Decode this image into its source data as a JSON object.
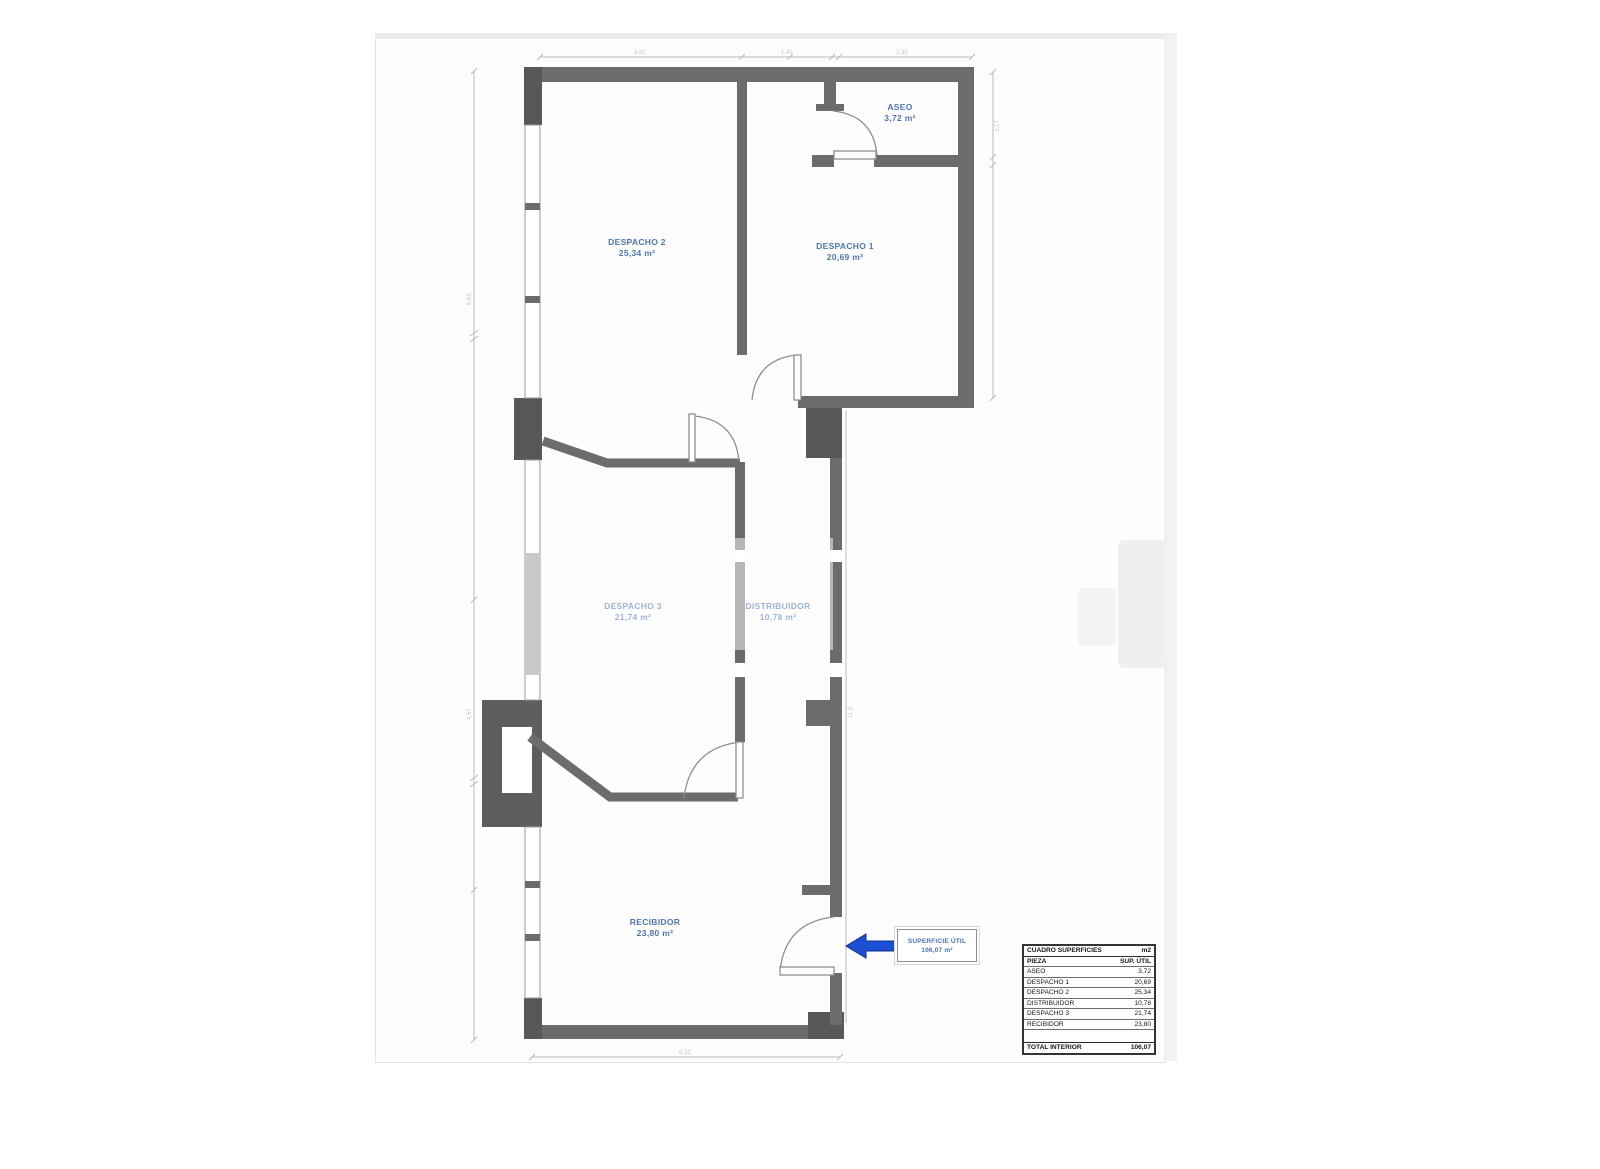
{
  "plan": {
    "rooms": [
      {
        "name": "ASEO",
        "area": "3,72 m²"
      },
      {
        "name": "DESPACHO 2",
        "area": "25,34 m²"
      },
      {
        "name": "DESPACHO 1",
        "area": "20,69 m²"
      },
      {
        "name": "DESPACHO 3",
        "area": "21,74 m²"
      },
      {
        "name": "DISTRIBUIDOR",
        "area": "10,78 m²"
      },
      {
        "name": "RECIBIDOR",
        "area": "23,80 m²"
      }
    ],
    "callout": {
      "title": "SUPERFICIE ÚTIL",
      "value": "106,07 m²"
    },
    "dimensions": {
      "top": [
        "3,42",
        "1,41",
        "2,35"
      ],
      "bottom": "6,31",
      "left_upper": "8,65",
      "left_lower": "4,57",
      "right": "3,17",
      "inner_right": "11,9"
    },
    "colors": {
      "wall": "#6c6c6c",
      "wall_block": "#58585a",
      "label_blue": "#4f76b2",
      "arrow_blue": "#1d4fd6",
      "dimension_gray": "#b9b9b9"
    }
  },
  "table": {
    "title": "CUADRO SUPERFICIES",
    "unit": "m2",
    "columns": {
      "piece": "PIEZA",
      "area": "SUP. ÚTIL"
    },
    "rows": [
      {
        "label": "ASEO",
        "value": "3,72"
      },
      {
        "label": "DESPACHO 1",
        "value": "20,69"
      },
      {
        "label": "DESPACHO 2",
        "value": "25,34"
      },
      {
        "label": "DISTRIBUIDOR",
        "value": "10,78"
      },
      {
        "label": "DESPACHO 3",
        "value": "21,74"
      },
      {
        "label": "RECIBIDOR",
        "value": "23,80"
      }
    ],
    "total": {
      "label": "TOTAL INTERIOR",
      "value": "106,07"
    }
  }
}
